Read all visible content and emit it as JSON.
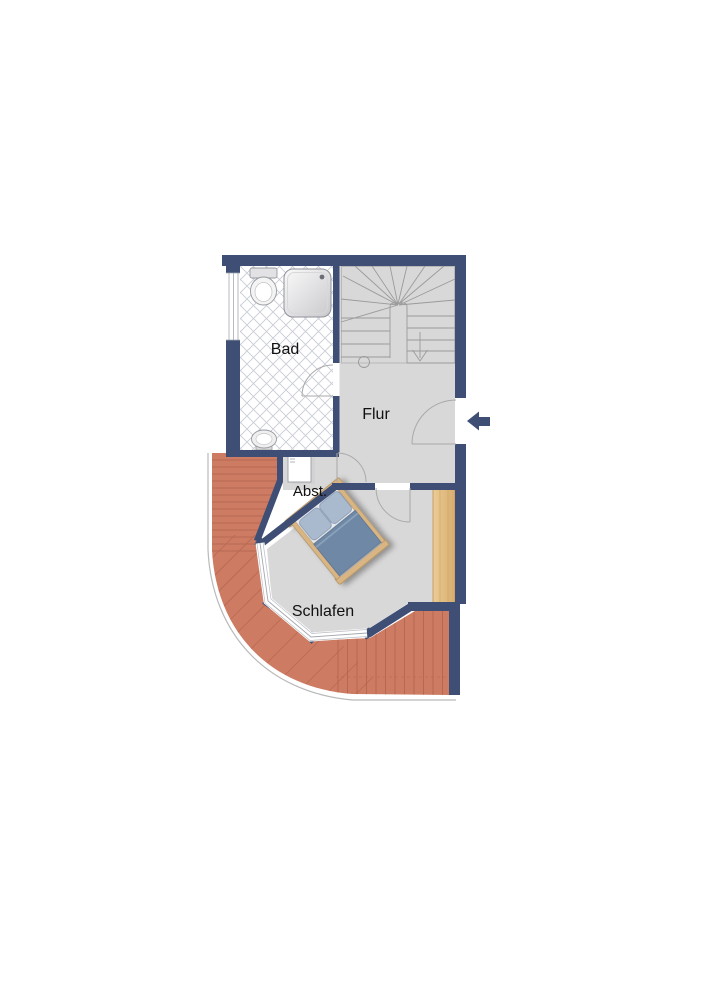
{
  "plan": {
    "title": "floor-plan-upper-level",
    "rooms": {
      "bad": {
        "label": "Bad"
      },
      "flur": {
        "label": "Flur"
      },
      "abst": {
        "label": "Abst."
      },
      "schlafen": {
        "label": "Schlafen"
      }
    },
    "fixtures": [
      "stairs",
      "toilet",
      "shower",
      "sink",
      "washing-machine",
      "bed",
      "wardrobe",
      "terrace",
      "bay-windows",
      "entrance-arrow"
    ],
    "colors": {
      "wall": "#3e4e74",
      "floor": "#d8d8d8",
      "bath_tile_line": "#c9ccd4",
      "terrace": "#cd7b62",
      "terrace_line": "#ad614c",
      "wood": "#e2bb80",
      "bed_blanket": "#6e88a6",
      "bed_pillow": "#a9bacf",
      "bed_frame": "#d9b584",
      "stair_line": "#9a9a9a"
    }
  }
}
